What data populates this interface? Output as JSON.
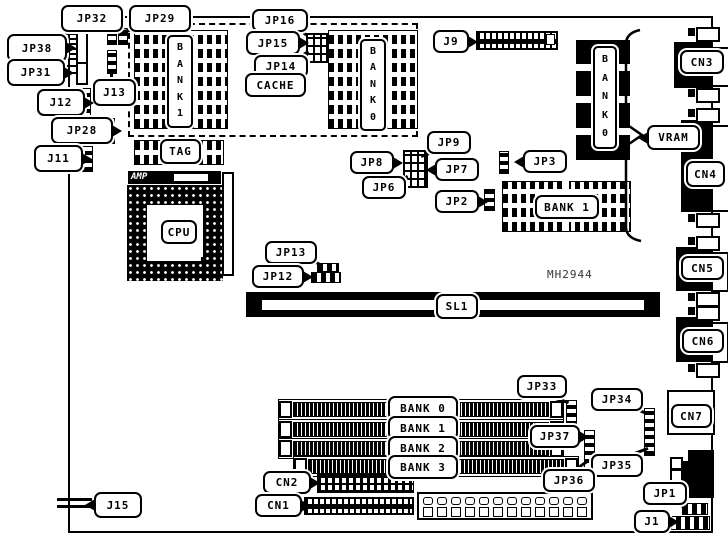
{
  "colors": {
    "ink": "#000000",
    "paper": "#ffffff"
  },
  "figure": {
    "type": "motherboard-layout-diagram",
    "board_part_number": "MH2944"
  },
  "labels": {
    "jp32": "JP32",
    "jp29": "JP29",
    "jp38": "JP38",
    "jp31": "JP31",
    "j12": "J12",
    "jp28": "JP28",
    "j11": "J11",
    "j13": "J13",
    "j15": "J15",
    "jp16": "JP16",
    "jp15": "JP15",
    "jp14": "JP14",
    "cache": "CACHE",
    "tag": "TAG",
    "amp": "AMP",
    "cpu": "CPU",
    "j9": "J9",
    "jp9": "JP9",
    "jp8": "JP8",
    "jp7": "JP7",
    "jp6": "JP6",
    "jp3": "JP3",
    "jp2": "JP2",
    "jp13": "JP13",
    "jp12": "JP12",
    "sl1": "SL1",
    "mh2944": "MH2944",
    "vram": "VRAM",
    "cn1": "CN1",
    "cn2": "CN2",
    "cn3": "CN3",
    "cn4": "CN4",
    "cn5": "CN5",
    "cn6": "CN6",
    "cn7": "CN7",
    "jp33": "JP33",
    "jp34": "JP34",
    "jp35": "JP35",
    "jp36": "JP36",
    "jp37": "JP37",
    "jp1": "JP1",
    "j1": "J1"
  },
  "chips": {
    "cache_bank1_vertical": "B\nA\nN\nK\n1",
    "cache_bank0_vertical": "B\nA\nN\nK\n0",
    "vram_bank0_vertical": "B\nA\nN\nK\n0",
    "vram_bank1": "BANK 1"
  },
  "memory": {
    "simm_banks": [
      "BANK 0",
      "BANK 1",
      "BANK 2",
      "BANK 3"
    ]
  }
}
